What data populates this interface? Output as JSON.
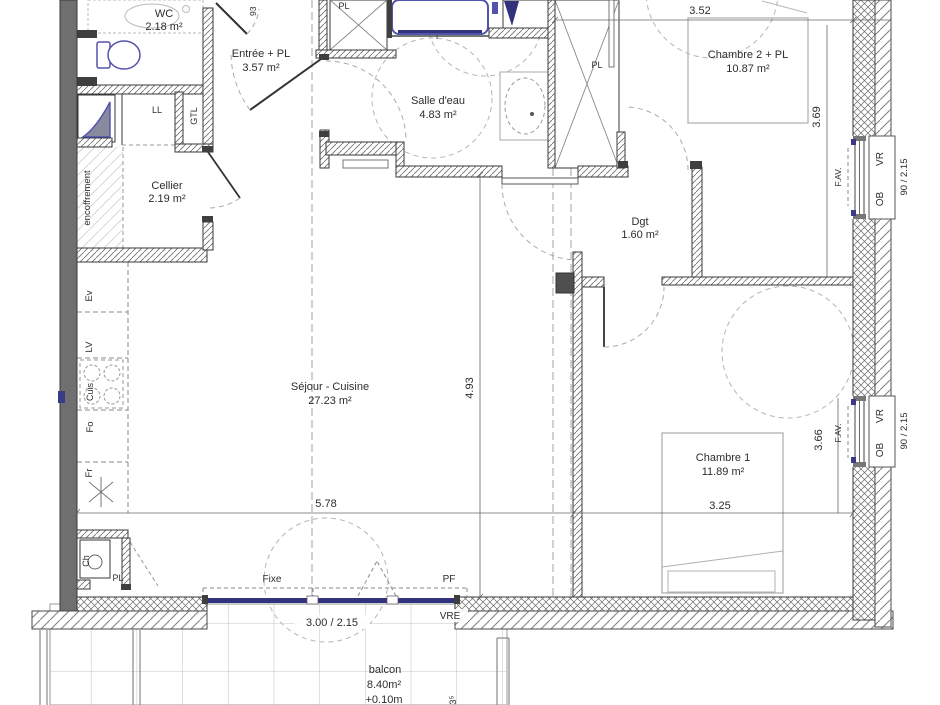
{
  "rooms": {
    "wc": {
      "name": "WC",
      "area": "2.18 m²"
    },
    "entree": {
      "name": "Entrée + PL",
      "area": "3.57 m²"
    },
    "salle_eau": {
      "name": "Salle d'eau",
      "area": "4.83 m²"
    },
    "chambre2": {
      "name": "Chambre 2 + PL",
      "area": "10.87 m²"
    },
    "cellier": {
      "name": "Cellier",
      "area": "2.19 m²"
    },
    "dgt": {
      "name": "Dgt",
      "area": "1.60 m²"
    },
    "sejour": {
      "name": "Séjour - Cuisine",
      "area": "27.23 m²"
    },
    "chambre1": {
      "name": "Chambre 1",
      "area": "11.89 m²"
    },
    "balcon": {
      "name": "balcon",
      "area": "8.40m²",
      "level": "+0.10m"
    }
  },
  "dimensions": {
    "chambre2_width": "3.52",
    "chambre2_depth": "3.69",
    "sejour_width": "5.78",
    "sejour_depth": "4.93",
    "chambre1_width": "3.25",
    "chambre1_depth": "3.66",
    "balcony_window": "3.00 / 2.15",
    "window_right": "90 / 2.15",
    "entry_door": "93",
    "balcony_depth": "1.63⁵"
  },
  "equipment_labels": {
    "ll": "LL",
    "gtl": "GTL",
    "pl": "PL",
    "ev": "Ev",
    "lv": "LV",
    "cuis": "Cuis",
    "fo": "Fo",
    "fr": "Fr",
    "ch": "Ch",
    "encoffrement": "encoffrement"
  },
  "window_labels": {
    "fixe": "Fixe",
    "pf": "PF",
    "vre": "VRE",
    "vr": "VR",
    "ob": "OB",
    "fav": "F.AV."
  },
  "colors": {
    "fixture": "#5353ac",
    "window_navy": "#32327d",
    "encoffrement_blue": "#3f9fd0",
    "wall_dark": "#3c3c3c",
    "left_wall_gray": "#6f6f6f",
    "column_gray": "#4f4f4f"
  }
}
